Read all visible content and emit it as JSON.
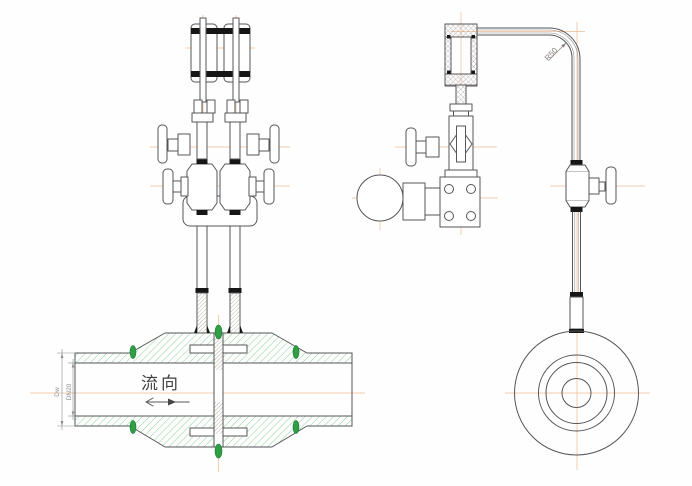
{
  "drawing": {
    "flow_label": "流向",
    "annotations": {
      "outer_diameter": "Dw",
      "bore_diameter": "DN20",
      "bend_radius": "R50"
    },
    "colors": {
      "background": "#fefefe",
      "line": "#55555a",
      "centerline": "#f0bb90",
      "pipe_hatch": "#8fd19b",
      "fine_hatch": "#9d9084",
      "gray_hatch": "#a39494",
      "weld": "#2f9e44",
      "joint": "#161616",
      "dim": "#8c8c8c",
      "annotation_text": "#8a7d7d"
    }
  }
}
